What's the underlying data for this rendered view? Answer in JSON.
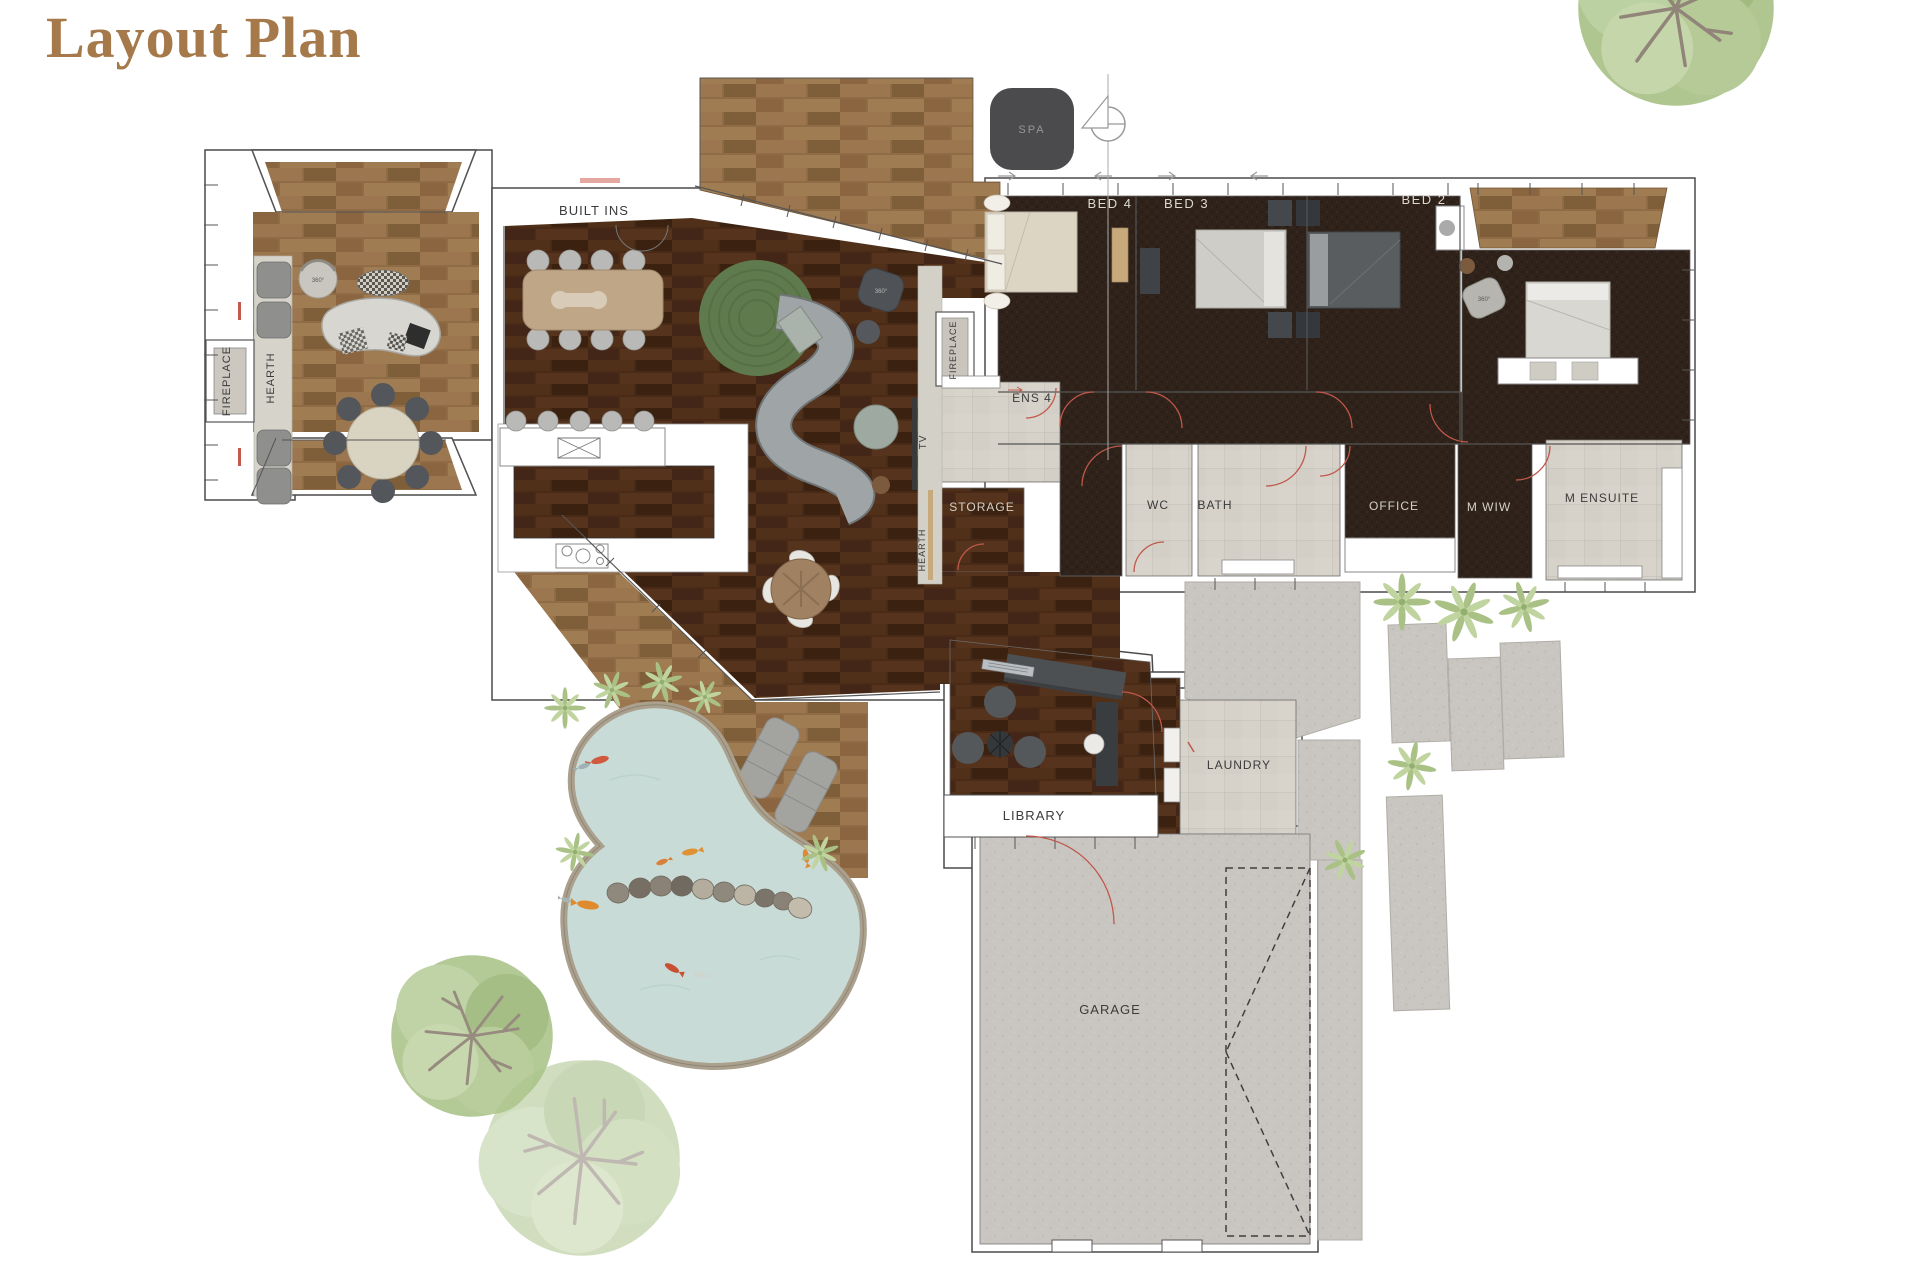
{
  "title": "Layout Plan",
  "rooms": {
    "built_ins": "BUILT INS",
    "bed4": "BED 4",
    "bed3": "BED 3",
    "bed2": "BED 2",
    "ens4": "ENS 4",
    "storage": "STORAGE",
    "wc": "WC",
    "bath": "BATH",
    "office": "OFFICE",
    "m_wiw": "M WIW",
    "m_ensuite": "M ENSUITE",
    "laundry": "LAUNDRY",
    "library": "LIBRARY",
    "garage": "GARAGE",
    "spa": "SPA"
  },
  "fixtures": {
    "fireplace_left": "FIREPLACE",
    "hearth_left": "HEARTH",
    "fireplace_center": "FIREPLACE",
    "tv": "TV",
    "hearth_center": "HEARTH"
  },
  "annotations": {
    "swivel": "360°"
  },
  "colors": {
    "title": "#a5794a",
    "wood_dark": "#482a17",
    "wood_medium": "#906c46",
    "carpet": "#2f221a",
    "tile": "#d6d2c9",
    "concrete": "#c9c6c1",
    "water": "#c8dbd6",
    "pond_edge": "#aaa08d",
    "foliage": "#abc48b",
    "door_swing_red": "#c0584b",
    "spa_panel": "#4b4b4d",
    "sofa_grey": "#9fa4a6"
  }
}
